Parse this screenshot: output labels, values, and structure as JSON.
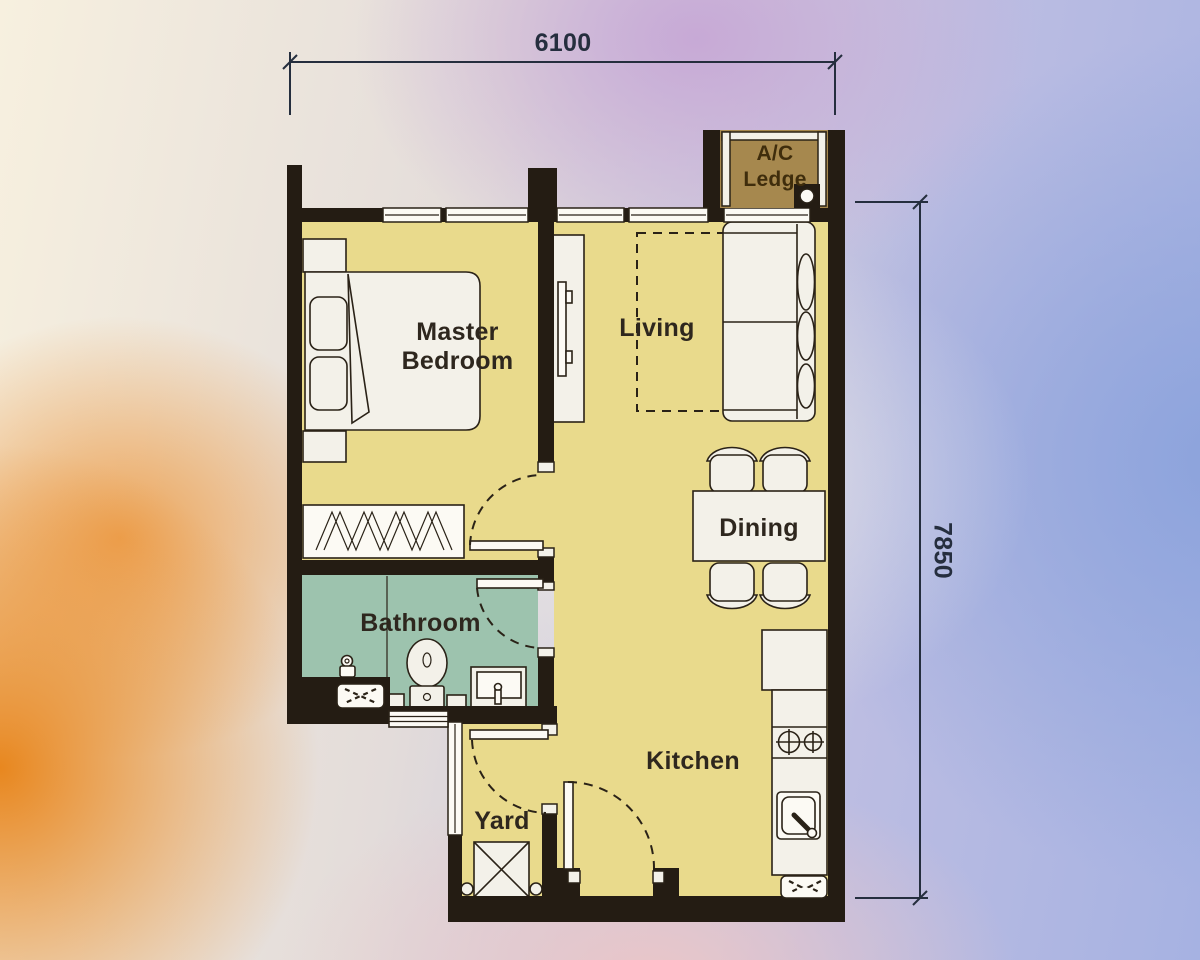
{
  "plan": {
    "type": "apartment-floor-plan",
    "unit_dimensions": {
      "width_mm": "6100",
      "height_mm": "7850"
    },
    "rooms": {
      "master_bedroom": "Master Bedroom",
      "living": "Living",
      "dining": "Dining",
      "kitchen": "Kitchen",
      "bathroom": "Bathroom",
      "yard": "Yard",
      "ac_ledge": "A/C Ledge"
    },
    "fixtures": {
      "master_bedroom": [
        "double-bed",
        "pillows",
        "folded-blanket",
        "nightstand-top",
        "nightstand-bottom",
        "wardrobe-rail"
      ],
      "living": [
        "tv-console",
        "tv",
        "dashed-rug",
        "sofa",
        "back-cushions"
      ],
      "dining": [
        "dining-table",
        "dining-chairs-x4"
      ],
      "kitchen": [
        "refrigerator",
        "counter",
        "stove-2-burner",
        "sink",
        "louvre-vent",
        "entrance-door-swing"
      ],
      "bathroom": [
        "shower-area",
        "shower-valve",
        "toilet",
        "floor-trap",
        "vanity-basin",
        "louvre-vent",
        "threshold-grille",
        "door-swing"
      ],
      "yard": [
        "louvre-window",
        "washer-unit",
        "door-swing-to-kitchen"
      ],
      "ac_ledge": [
        "condenser-unit"
      ]
    },
    "colors": {
      "wall": "#241c13",
      "floor": "#e9da8c",
      "bathroom_floor": "#9dc3ae",
      "ac_ledge_floor": "#a6884e",
      "fixture": "#f3f1e9",
      "outline": "#2a2217",
      "room_label": "#2e271e",
      "ac_label": "#3f2d0c",
      "dimension": "#252e3e"
    },
    "background": {
      "cream": "#f7f0df",
      "orange": "#e8871f",
      "purple": "#c7a9d6",
      "blue": "#8ca3dc",
      "pink": "#eac6c8"
    }
  }
}
